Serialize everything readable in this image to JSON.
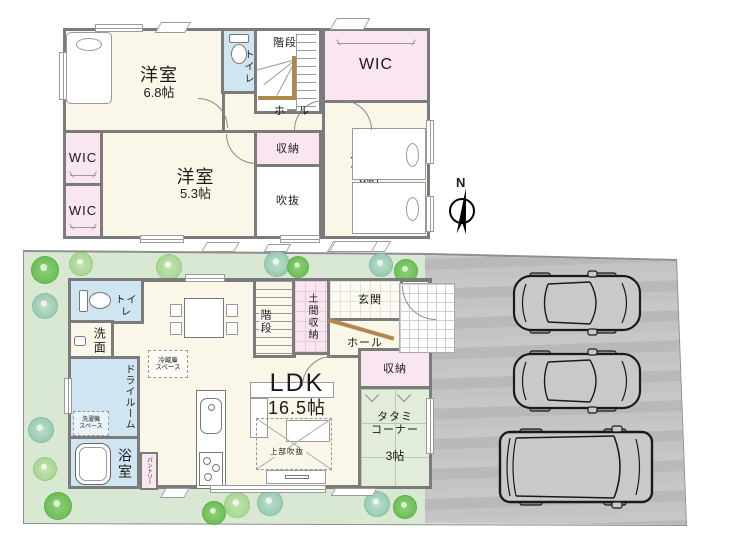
{
  "floor2": {
    "room_68": {
      "name": "洋室",
      "area": "6.8帖"
    },
    "toilet": "トイレ",
    "stairs": "階段",
    "wic_top": "WIC",
    "hall": "ホール",
    "closet": "収納",
    "room_53": {
      "name": "洋室",
      "area": "5.3帖"
    },
    "wic_mid": "WIC",
    "wic_low": "WIC",
    "void": "吹抜",
    "room_6": {
      "name": "洋室",
      "area": "6帖"
    }
  },
  "compass": {
    "north": "N"
  },
  "floor1": {
    "toilet": "トイレ",
    "washroom": "洗面",
    "dry_room": "ドライルーム",
    "washer_space": "洗濯機\nスペース",
    "bathroom": "浴室",
    "pantry": "パントリー",
    "fridge_space": "冷蔵庫\nスペース",
    "stairs": "階段",
    "doma_storage": "土間収納",
    "entrance": "玄関",
    "hall": "ホール",
    "closet": "収納",
    "tatami": {
      "name": "タタミ\nコーナー",
      "area": "3帖"
    },
    "ldk": {
      "name": "LDK",
      "area": "16.5帖"
    },
    "upper_void": "上部吹抜"
  },
  "colors": {
    "wall": "#7b7b7b",
    "room_cream": "#faf7e8",
    "closet_pink": "#f9e6f0",
    "wet_blue": "#cfe5f2",
    "tatami_green": "#e1edd9",
    "lawn_green": "#d8e8d3",
    "parking_gray": "#c0c0c2",
    "wood_brown": "#b1884b"
  }
}
